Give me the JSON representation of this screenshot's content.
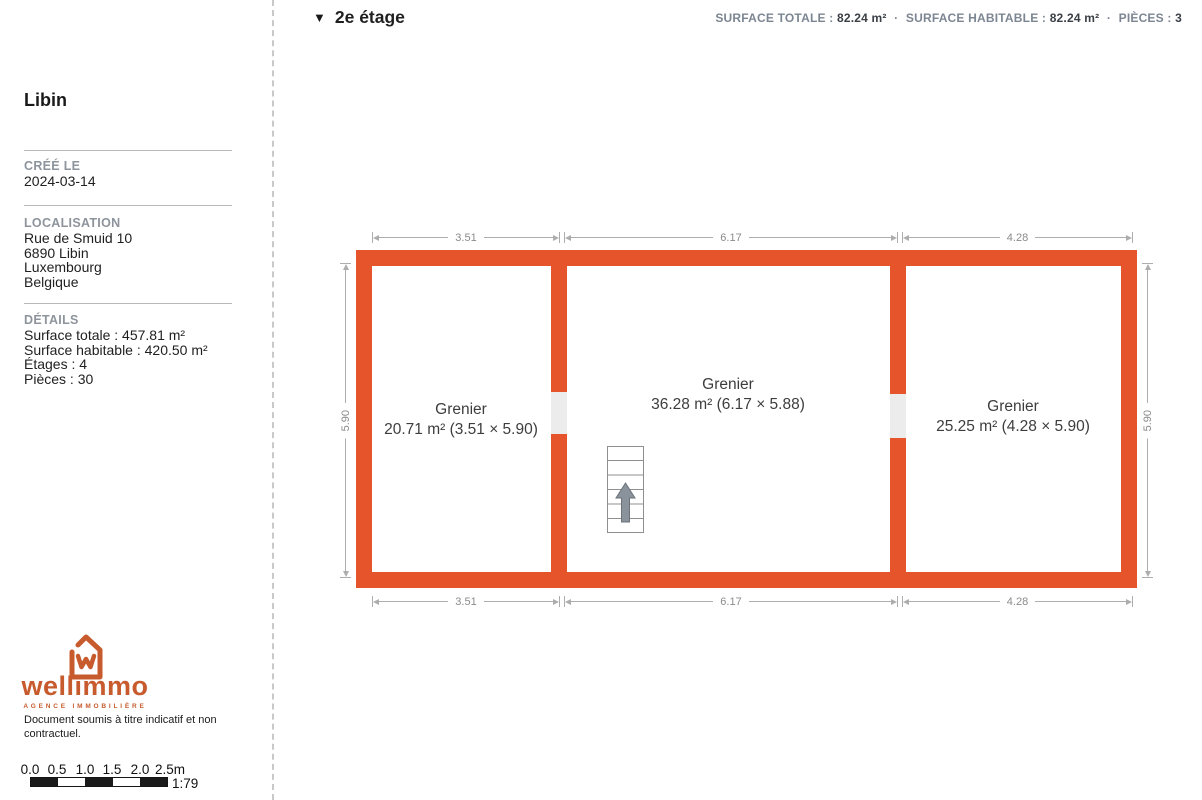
{
  "sidebar": {
    "title": "Libin",
    "created": {
      "label": "CRÉÉ LE",
      "value": "2024-03-14"
    },
    "location": {
      "label": "LOCALISATION",
      "lines": [
        "Rue de Smuid 10",
        "6890 Libin",
        "Luxembourg",
        "Belgique"
      ]
    },
    "details": {
      "label": "DÉTAILS",
      "lines": [
        "Surface totale : 457.81 m²",
        "Surface habitable : 420.50 m²",
        "Étages : 4",
        "Pièces : 30"
      ]
    },
    "logo": {
      "brand": "wellimmo",
      "tagline": "AGENCE IMMOBILIÈRE",
      "icon": "house-w-icon"
    },
    "disclaimer": "Document soumis à titre indicatif et non contractuel.",
    "scalebar": {
      "tick_labels": [
        "0.0",
        "0.5",
        "1.0",
        "1.5",
        "2.0",
        "2.5m"
      ],
      "ratio": "1:79"
    }
  },
  "header": {
    "collapse_icon": "▼",
    "floor_title": "2e étage",
    "separator": "·",
    "stats": [
      {
        "label": "SURFACE TOTALE :",
        "value": "82.24 m²"
      },
      {
        "label": "SURFACE HABITABLE :",
        "value": "82.24 m²"
      },
      {
        "label": "PIÈCES :",
        "value": "3"
      }
    ]
  },
  "floorplan": {
    "rooms": [
      {
        "name": "Grenier",
        "area": "20.71 m² (3.51 × 5.90)"
      },
      {
        "name": "Grenier",
        "area": "36.28 m² (6.17 × 5.88)"
      },
      {
        "name": "Grenier",
        "area": "25.25 m² (4.28 × 5.90)"
      }
    ],
    "dimensions": {
      "top": [
        "3.51",
        "6.17",
        "4.28"
      ],
      "bottom": [
        "3.51",
        "6.17",
        "4.28"
      ],
      "left": "5.90",
      "right": "5.90"
    },
    "stairs_icon": "stairs-up-arrow-icon",
    "colors": {
      "wall": "#e5542b",
      "logo": "#c75b2e",
      "dimension": "#adadad",
      "door_gap": "#ececec"
    }
  }
}
